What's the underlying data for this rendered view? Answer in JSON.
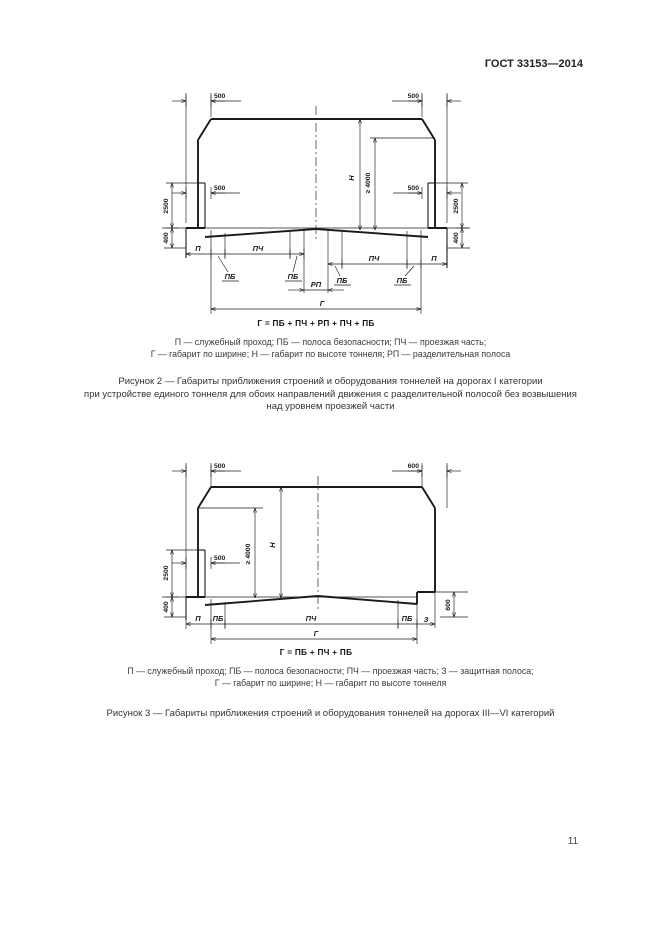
{
  "page": {
    "header": "ГОСТ 33153—2014",
    "page_number": "11"
  },
  "figure2": {
    "dim_labels": {
      "top_left": "500",
      "top_right": "500",
      "walkway_left": "500",
      "walkway_right": "500",
      "wall_height_left": "2500",
      "wall_height_right": "2500",
      "curb_left": "400",
      "curb_right": "400",
      "height_gauge": "Н",
      "min_clearance": "≥ 4000",
      "divider": "РП",
      "width_gauge": "Г"
    },
    "zone_labels": {
      "service_left": "П",
      "service_right": "П",
      "safety_1": "ПБ",
      "safety_2": "ПБ",
      "safety_3": "ПБ",
      "safety_4": "ПБ",
      "carriageway_left": "ПЧ",
      "carriageway_right": "ПЧ"
    },
    "formula": "Г = ПБ + ПЧ + РП + ПЧ + ПБ",
    "legend_lines": [
      "П — служебный проход; ПБ — полоса безопасности; ПЧ — проезжая часть;",
      "Г — габарит по ширине; Н — габарит по высоте тоннеля; РП — разделительная полоса"
    ],
    "caption_lines": [
      "Рисунок 2 — Габариты приближения строений и оборудования тоннелей на дорогах I категории",
      "при устройстве единого тоннеля для обоих направлений движения с разделительной полосой без возвышения",
      "над уровнем проезжей части"
    ]
  },
  "figure3": {
    "dim_labels": {
      "top_left": "500",
      "top_right": "600",
      "walkway_left": "500",
      "wall_height_left": "2500",
      "curb_left": "400",
      "curb_right": "600",
      "height_gauge": "Н",
      "min_clearance": "≥ 4000",
      "width_gauge": "Г"
    },
    "zone_labels": {
      "service": "П",
      "safety_left": "ПБ",
      "safety_right": "ПБ",
      "carriageway": "ПЧ",
      "protective": "З"
    },
    "formula": "Г = ПБ + ПЧ + ПБ",
    "legend_lines": [
      "П — служебный проход; ПБ — полоса безопасности; ПЧ — проезжая часть; З — защитная полоса;",
      "Г — габарит по ширине; Н — габарит по высоте тоннеля"
    ],
    "caption": "Рисунок 3 — Габариты приближения строений и оборудования тоннелей на дорогах III—VI категорий"
  }
}
